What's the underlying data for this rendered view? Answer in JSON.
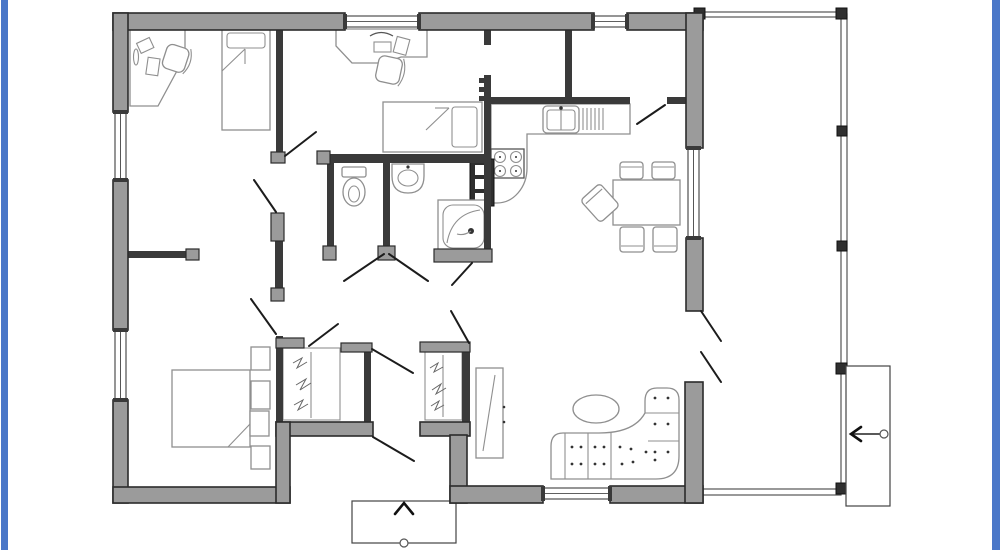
{
  "title": "Single-storey house floor plan with side porch",
  "frame": {
    "color": "#4a77c8"
  },
  "palette": {
    "wall_fill": "#9b9b9b",
    "wall_stroke": "#2b2b2b",
    "interior_wall": "#3a3a3a",
    "furniture_stroke": "#8f8f8f",
    "furniture_dark": "#555555",
    "door_line": "#1c1c1c",
    "porch_stroke": "#555555",
    "accent_dark": "#2f2f2f",
    "floor": "#ffffff"
  },
  "areas": [
    "bedroom-top-left",
    "bedroom-top-center",
    "storage-left",
    "storage-right",
    "kitchen",
    "dining-area",
    "wc",
    "washroom",
    "shower-room",
    "hallway",
    "master-bedroom",
    "living-room",
    "entry",
    "porch"
  ],
  "fixtures": [
    "corner-desk",
    "office-chair",
    "single-bed",
    "wardrobe",
    "toilet",
    "wall-sink",
    "shower-cabin",
    "water-heater",
    "kitchen-counter",
    "kitchen-sink",
    "stove",
    "dining-table",
    "dining-chair",
    "double-bed",
    "nightstand-column",
    "tv-cabinet",
    "sectional-sofa",
    "coffee-table",
    "porch-railing",
    "outdoor-staircase",
    "entry-steps"
  ],
  "annotations": {
    "stair_direction_arrow": "left",
    "entry_direction_arrow": "up"
  }
}
